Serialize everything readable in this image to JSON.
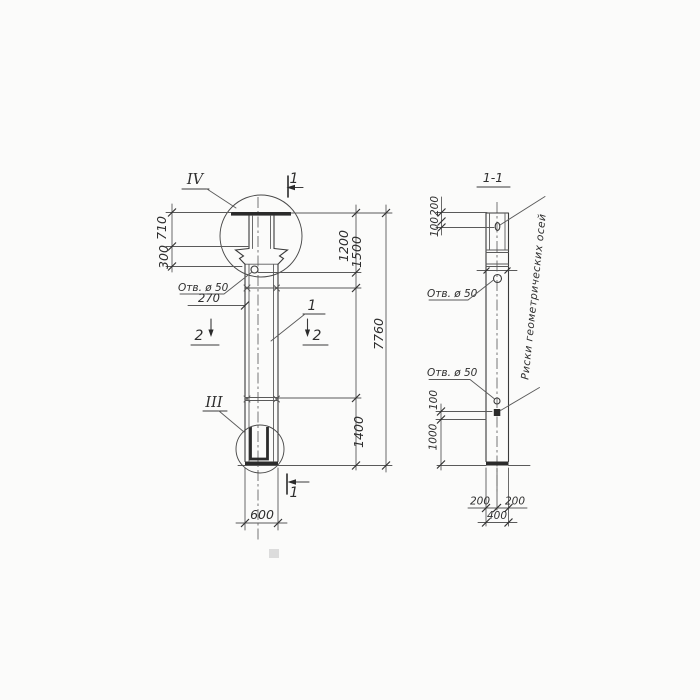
{
  "front_view": {
    "detail_top_label": "IV",
    "detail_bottom_label": "III",
    "part_label": "1",
    "section1_top": "1",
    "section1_bottom": "1",
    "section2_left": "2",
    "section2_right": "2",
    "hole_note": "Отв. ø 50",
    "dims": {
      "head": "710",
      "flare": "300",
      "hole_offset": "270",
      "upper_1200": "1200",
      "upper_1500": "1500",
      "total": "7760",
      "lower": "1400",
      "width": "600"
    }
  },
  "section_view": {
    "title": "1-1",
    "hole_note_upper": "Отв. ø 50",
    "hole_note_lower": "Отв. ø 50",
    "axes_note": "Риски геометрических осей",
    "dims": {
      "top_200": "200",
      "top_100": "100",
      "mid_100": "100",
      "mid_1000": "1000",
      "bottom_left_200": "200",
      "bottom_right_200": "200",
      "bottom_400": "400"
    }
  }
}
